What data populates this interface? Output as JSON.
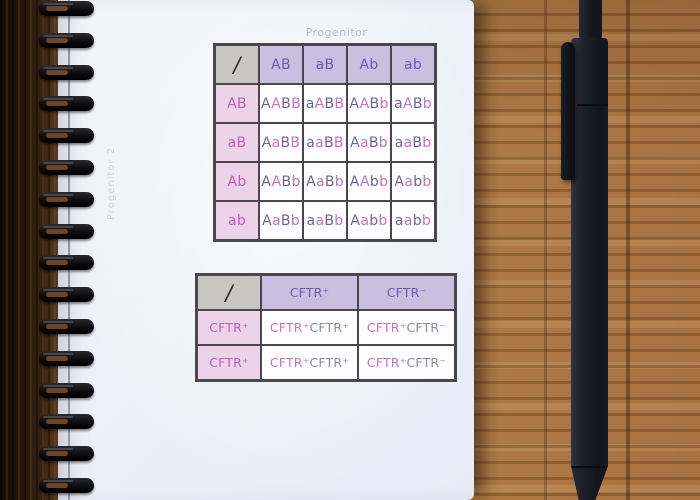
{
  "page": {
    "top_label": "Progenitor",
    "side_label": "Progenitor 2"
  },
  "punnett_large": {
    "corner": "/",
    "col_headers": [
      "AB",
      "aB",
      "Ab",
      "ab"
    ],
    "row_headers": [
      "AB",
      "aB",
      "Ab",
      "ab"
    ],
    "cells": [
      [
        [
          "A",
          "A",
          "B",
          "B"
        ],
        [
          "a",
          "A",
          "B",
          "B"
        ],
        [
          "A",
          "A",
          "B",
          "b"
        ],
        [
          "a",
          "A",
          "B",
          "b"
        ]
      ],
      [
        [
          "A",
          "a",
          "B",
          "B"
        ],
        [
          "a",
          "a",
          "B",
          "B"
        ],
        [
          "A",
          "a",
          "B",
          "b"
        ],
        [
          "a",
          "a",
          "B",
          "b"
        ]
      ],
      [
        [
          "A",
          "A",
          "B",
          "b"
        ],
        [
          "A",
          "a",
          "B",
          "b"
        ],
        [
          "A",
          "A",
          "b",
          "b"
        ],
        [
          "A",
          "a",
          "b",
          "b"
        ]
      ],
      [
        [
          "A",
          "a",
          "B",
          "b"
        ],
        [
          "a",
          "a",
          "B",
          "b"
        ],
        [
          "A",
          "a",
          "b",
          "b"
        ],
        [
          "a",
          "a",
          "b",
          "b"
        ]
      ]
    ],
    "segment_cycle": [
      "slate",
      "pink"
    ]
  },
  "punnett_small": {
    "corner": "/",
    "col_headers": [
      "CFTR⁺",
      "CFTR⁻"
    ],
    "row_headers": [
      "CFTR⁺",
      "CFTR⁺"
    ],
    "cells": [
      [
        [
          "CFTR⁺",
          "CFTR⁺"
        ],
        [
          "CFTR⁺",
          "CFTR⁻"
        ]
      ],
      [
        [
          "CFTR⁺",
          "CFTR⁺"
        ],
        [
          "CFTR⁺",
          "CFTR⁻"
        ]
      ]
    ],
    "segment_cycle": [
      "pink",
      "slate2"
    ]
  },
  "colors": {
    "allele_slate": "#6b6890",
    "allele_pink": "#c475bc",
    "allele_slate_light": "#8d8aa6",
    "header_text_purple": "#695bb0",
    "row_header_text_pink": "#bb60b4",
    "header_bg_purple": "#c9c0e1",
    "row_header_bg_pink": "#ecd3e8",
    "corner_bg_gray": "#c7c6c2",
    "cell_bg": "#fdfcfe",
    "table_border": "#4a474d"
  }
}
